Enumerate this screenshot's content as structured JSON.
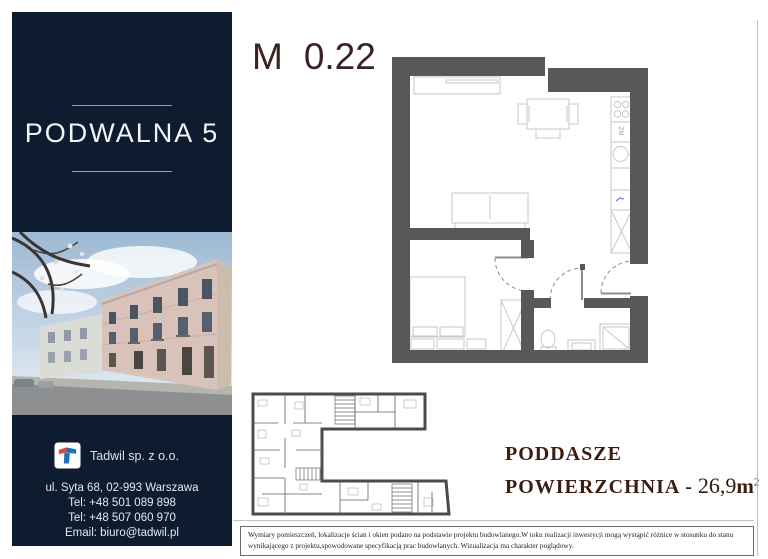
{
  "sidebar": {
    "title": "PODWALNA 5",
    "company_name": "Tadwil sp. z o.o.",
    "contact": [
      "ul. Syta 68, 02-993 Warszawa",
      "Tel: +48 501 089 898",
      "Tel: +48 507 060 970",
      "Email: biuro@tadwil.pl"
    ]
  },
  "unit": {
    "letter": "M",
    "number": "0.22"
  },
  "details": {
    "floor": "PODDASZE",
    "area_label": "POWIERZCHNIA -",
    "area_value": "26,9",
    "area_unit": "m",
    "area_sup": "2"
  },
  "floorplan": {
    "kitchen_label": "ZM"
  },
  "disclaimer": "Wymiary pomieszczeń, lokalizacje ścian i okien podano na podstawie projektu budowlanego.W toku realizacji inwestycji mogą wystąpić różnice w stosunku do stanu wynikającego z projektu,spowodowane specyfikacją prac budowlanych. Wizualizacja ma charakter poglądowy.",
  "colors": {
    "sidebar_navy": "#0e1c30",
    "heading_maroon": "#3e1b10",
    "unit_maroon": "#3a2320",
    "wall_gray": "#58585a",
    "furniture_gray": "#c7c7ca",
    "fixture_blue": "#7b7bff"
  }
}
